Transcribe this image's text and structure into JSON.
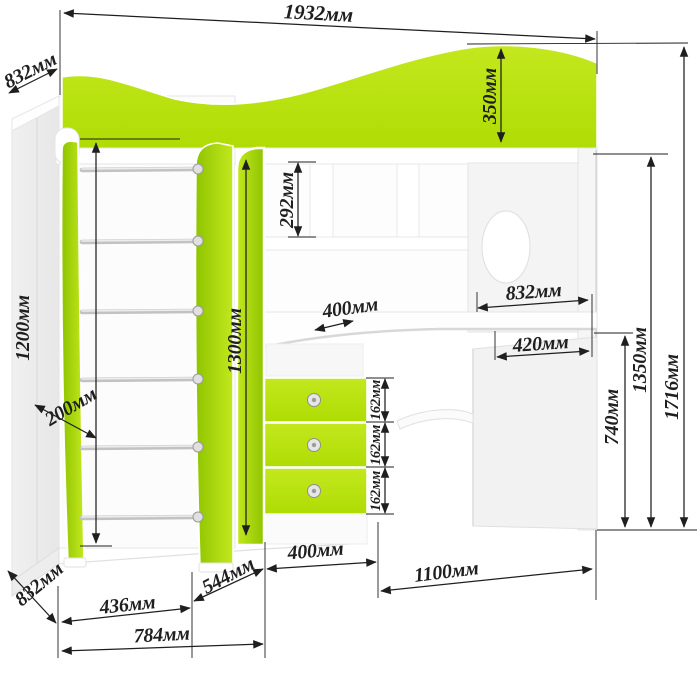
{
  "colors": {
    "lime": "#afdc04",
    "lime_light": "#c3e81e",
    "lime_dark": "#8ec400",
    "ink": "#1f1f1f",
    "side_panel": "#e7e7e7"
  },
  "dimensions": {
    "total_width": "1932мм",
    "wardrobe_depth_top": "832мм",
    "bed_rail_height": "350мм",
    "shelf_compartment_height": "292мм",
    "desk_depth": "832мм",
    "desk_return_width": "420мм",
    "total_height": "1716мм",
    "bed_platform_height": "1350мм",
    "desk_height": "740мм",
    "ladder_height": "1200мм",
    "ladder_depth": "200мм",
    "front_panel_height": "1300мм",
    "shelf_width": "400мм",
    "drawer_heights": [
      "162мм",
      "162мм",
      "162мм"
    ],
    "drawers_section_width": "400мм",
    "desk_section_width": "1100мм",
    "base_left_width": "436мм",
    "base_corner_depth": "544мм",
    "base_front_width": "784мм",
    "wardrobe_depth_bottom": "832мм"
  }
}
